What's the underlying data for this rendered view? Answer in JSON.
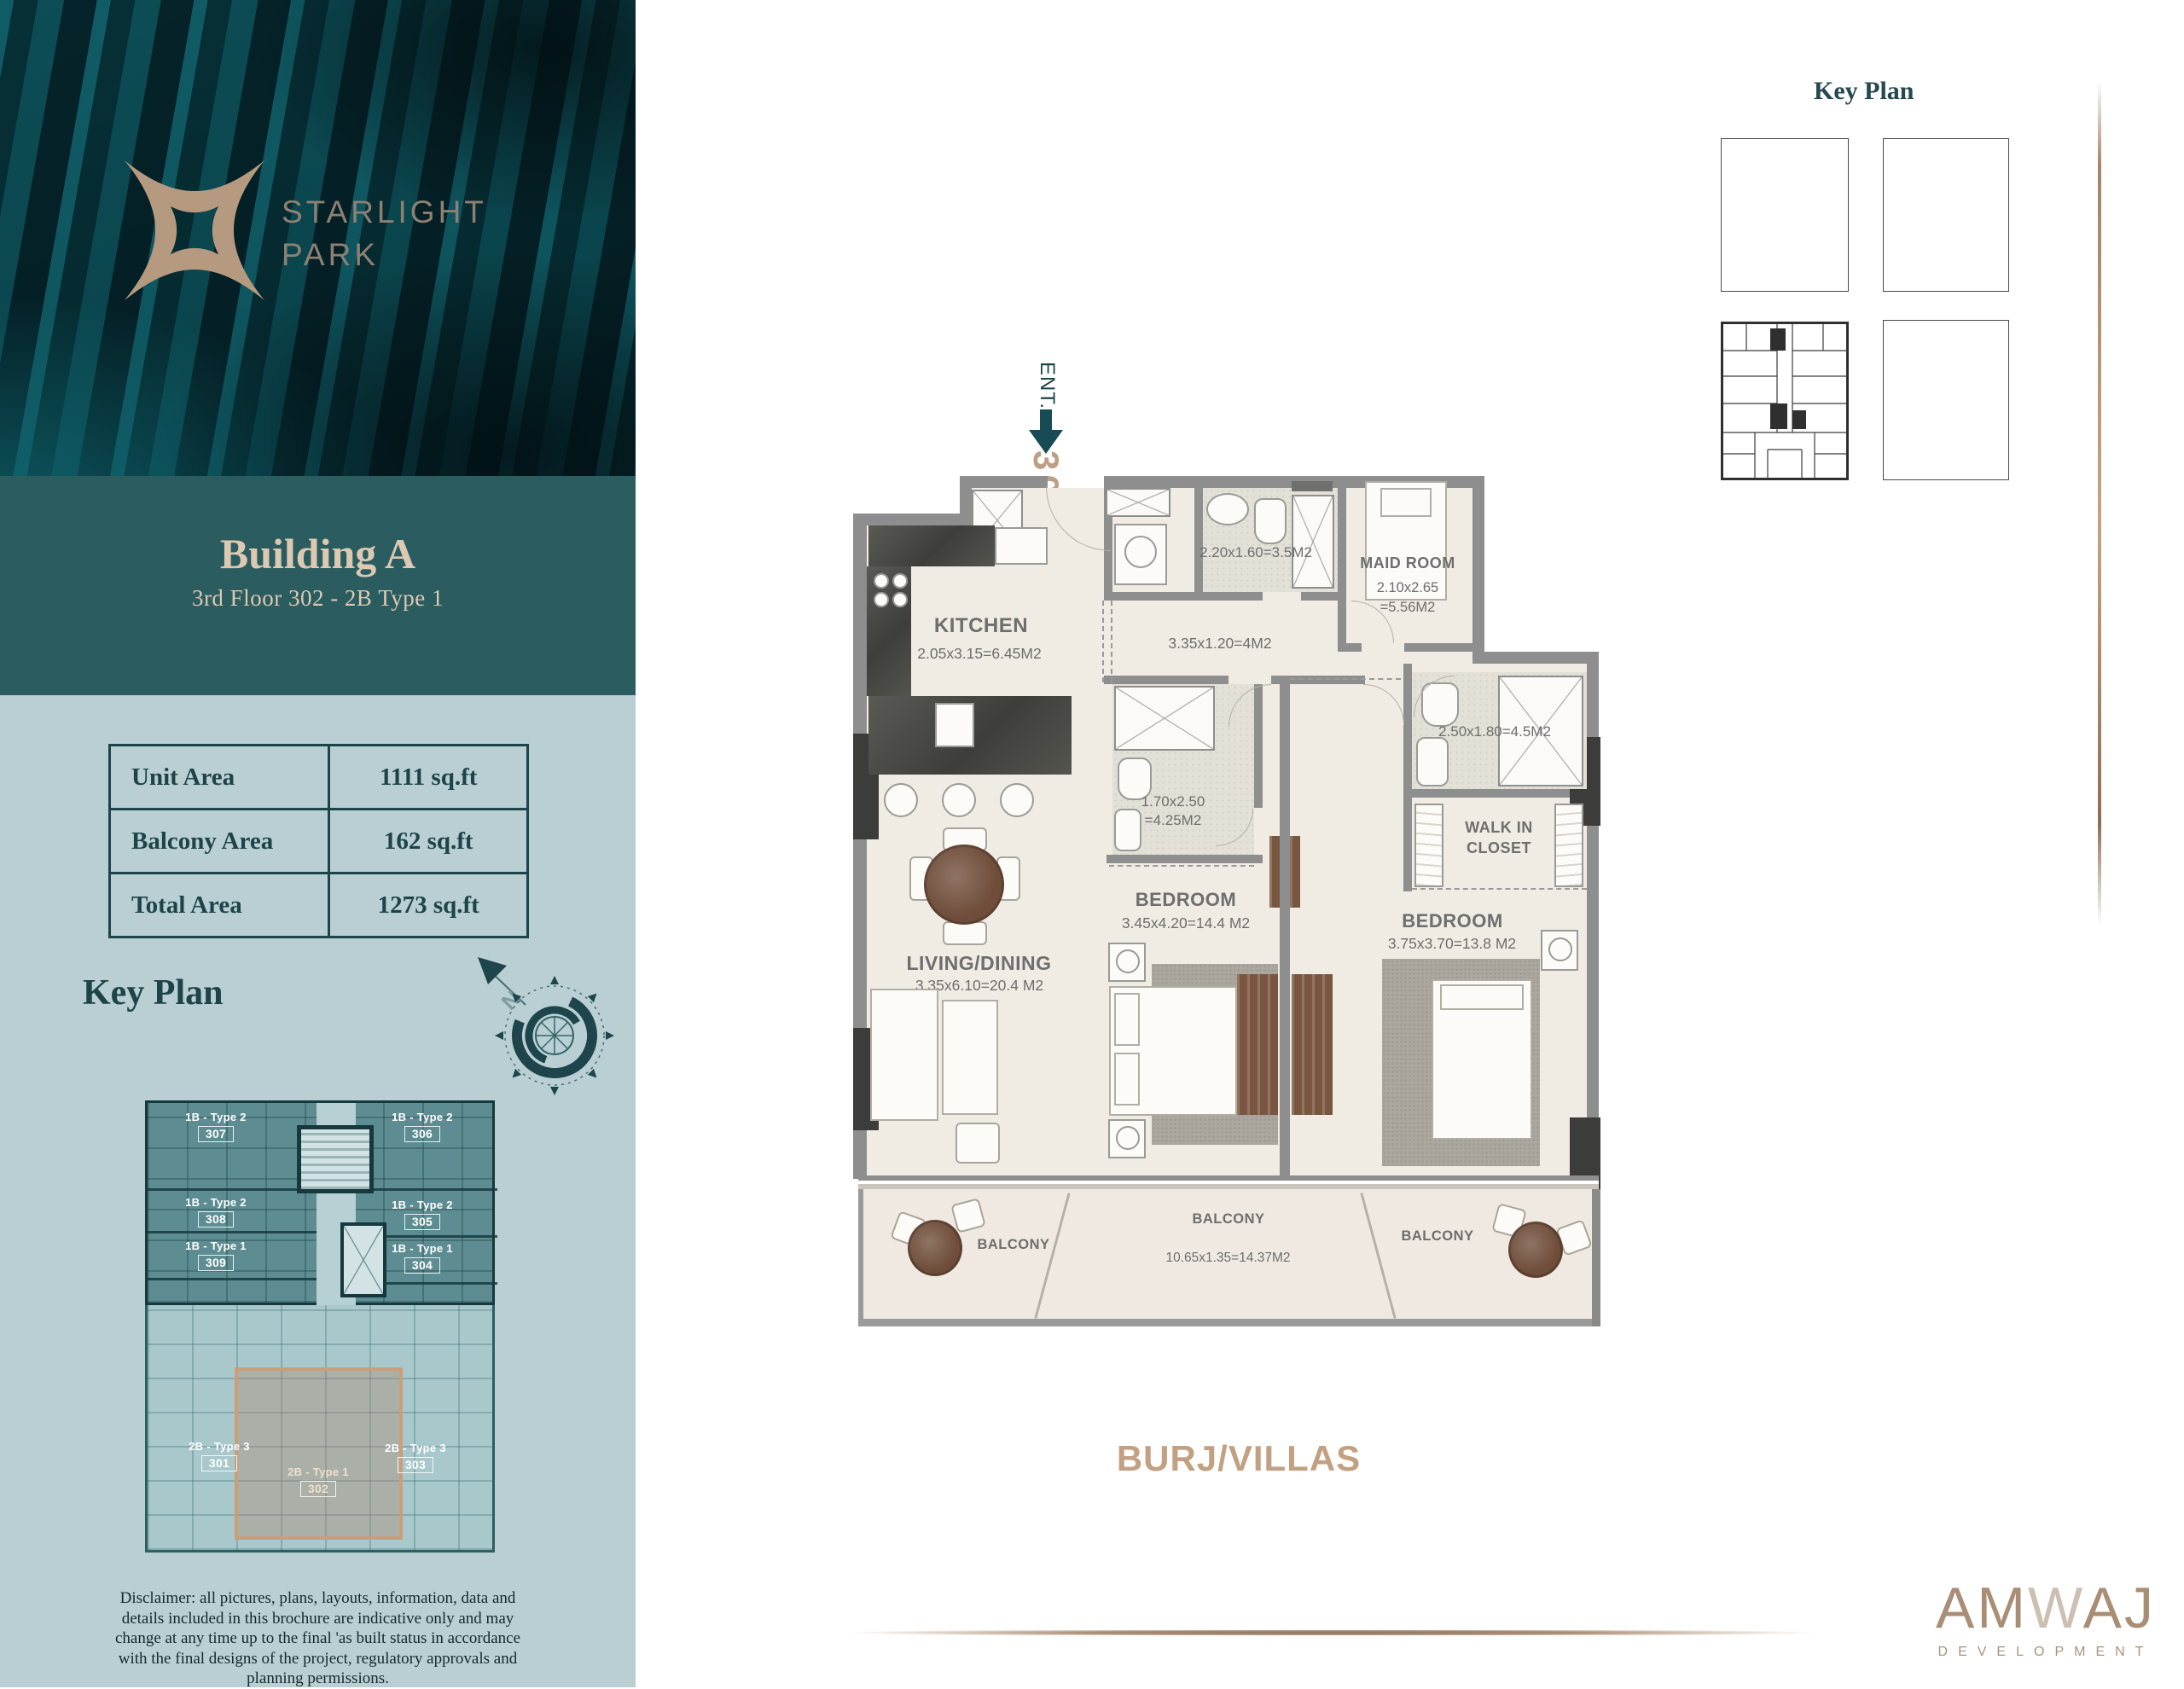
{
  "brand": {
    "line1": "STARLIGHT",
    "line2": "PARK"
  },
  "unit_header": {
    "building": "Building A",
    "subtitle": "3rd Floor 302 - 2B Type 1"
  },
  "area_table": {
    "rows": [
      {
        "label": "Unit Area",
        "value": "1111 sq.ft"
      },
      {
        "label": "Balcony Area",
        "value": "162 sq.ft"
      },
      {
        "label": "Total Area",
        "value": "1273 sq.ft"
      }
    ]
  },
  "sidebar_key_plan": {
    "heading": "Key Plan",
    "highlighted_unit": "302",
    "units": {
      "u307": {
        "type": "1B - Type 2",
        "num": "307"
      },
      "u306": {
        "type": "1B - Type 2",
        "num": "306"
      },
      "u308": {
        "type": "1B - Type 2",
        "num": "308"
      },
      "u305": {
        "type": "1B - Type 2",
        "num": "305"
      },
      "u309": {
        "type": "1B - Type 1",
        "num": "309"
      },
      "u304": {
        "type": "1B - Type 1",
        "num": "304"
      },
      "u301": {
        "type": "2B - Type 3",
        "num": "301"
      },
      "u302": {
        "type": "2B - Type 1",
        "num": "302"
      },
      "u303": {
        "type": "2B - Type 3",
        "num": "303"
      }
    }
  },
  "compass": {
    "north_label": "N"
  },
  "disclaimer": "Disclaimer: all pictures, plans, layouts, information, data and details included in this brochure are indicative only and may change at any time up to the final 'as built status in accordance with the final designs of the project, regulatory approvals and planning permissions.",
  "right_key_plan": {
    "heading": "Key Plan"
  },
  "floor_plan": {
    "entrance": {
      "label": "ENT.",
      "unit_number": "302"
    },
    "kitchen": {
      "name": "KITCHEN",
      "dims": "2.05x3.15=6.45M2"
    },
    "bath_top": {
      "dims": "2.20x1.60=3.5M2"
    },
    "maid_room": {
      "name": "MAID ROOM",
      "dims_line1": "2.10x2.65",
      "dims_line2": "=5.56M2"
    },
    "hallway": {
      "dims": "3.35x1.20=4M2"
    },
    "bath_right": {
      "dims": "2.50x1.80=4.5M2"
    },
    "bath_master": {
      "dims_line1": "1.70x2.50",
      "dims_line2": "=4.25M2"
    },
    "walk_in_closet": {
      "name_line1": "WALK IN",
      "name_line2": "CLOSET"
    },
    "bedroom_1": {
      "name": "BEDROOM",
      "dims": "3.45x4.20=14.4 M2"
    },
    "bedroom_2": {
      "name": "BEDROOM",
      "dims": "3.75x3.70=13.8 M2"
    },
    "living_dining": {
      "name": "LIVING/DINING",
      "dims": "3.35x6.10=20.4 M2"
    },
    "balcony_left": {
      "name": "BALCONY"
    },
    "balcony_center": {
      "name": "BALCONY",
      "dims": "10.65x1.35=14.37M2"
    },
    "balcony_right": {
      "name": "BALCONY"
    },
    "orientation_label": "BURJ/VILLAS"
  },
  "developer": {
    "name_prefix": "AM",
    "name_mid": "W",
    "name_suffix": "AJ",
    "tagline": "DEVELOPMENT"
  },
  "colors": {
    "teal_dark": "#1d4449",
    "teal_band": "#2b5c60",
    "sidebar_bg": "#b9cfd3",
    "tan_accent": "#c2a183",
    "wall_gray": "#8e8e8e"
  }
}
